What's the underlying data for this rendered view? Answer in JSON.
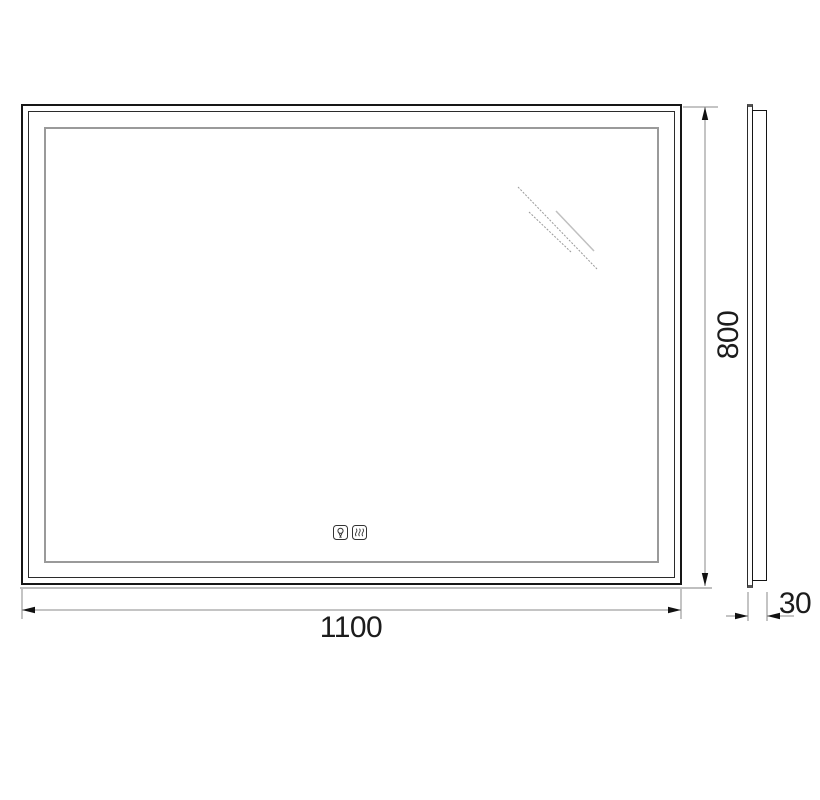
{
  "drawing": {
    "dimensions": {
      "width_label": "1100",
      "height_label": "800",
      "depth_label": "30"
    },
    "controls": [
      {
        "name": "light-bulb-icon"
      },
      {
        "name": "anti-fog-heater-icon"
      }
    ],
    "colors": {
      "background": "#ffffff",
      "outline": "#161616",
      "mid_frame": "#2b2b2b",
      "inner_frame": "#9a9a9a",
      "dimension_line": "#8a8a8a",
      "arrow": "#111111",
      "shadow_line": "#aaaaaa",
      "reflection": "#9a9a9a",
      "reflection_light": "#c0c0c0"
    }
  }
}
